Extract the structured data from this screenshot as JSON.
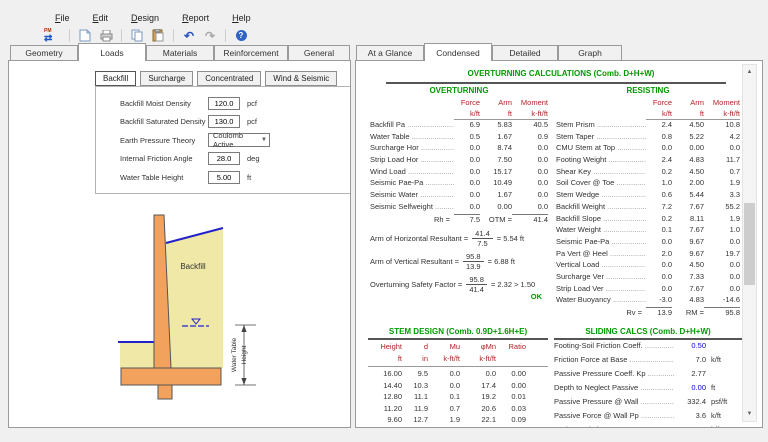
{
  "menu": {
    "items": [
      "File",
      "Edit",
      "Design",
      "Report",
      "Help"
    ]
  },
  "toolbar": {
    "pm_label": "PM",
    "icons": [
      "pm-toggle",
      "new-document",
      "print",
      "copy",
      "paste",
      "undo",
      "redo",
      "help"
    ]
  },
  "tabs_left": [
    "Geometry",
    "Loads",
    "Materials",
    "Reinforcement",
    "General"
  ],
  "tabs_right": [
    "At a Glance",
    "Condensed",
    "Detailed",
    "Graph"
  ],
  "loads_panel": {
    "subtabs": [
      "Backfill",
      "Surcharge",
      "Concentrated",
      "Wind & Seismic"
    ],
    "fields": [
      {
        "label": "Backfill Moist Density",
        "value": "120.0",
        "unit": "pcf"
      },
      {
        "label": "Backfill Saturated Density",
        "value": "130.0",
        "unit": "pcf"
      },
      {
        "label": "Earth Pressure Theory",
        "value": "Coulomb Active",
        "unit": ""
      },
      {
        "label": "Internal Friction Angle",
        "value": "28.0",
        "unit": "deg"
      },
      {
        "label": "Water Table Height",
        "value": "5.00",
        "unit": "ft"
      }
    ],
    "diagram": {
      "backfill_label": "Backfill",
      "dim_line1": "Water Table",
      "dim_line2": "Height"
    }
  },
  "colors": {
    "title_green": "#009900",
    "header_red": "#b22222",
    "input_blue": "#0000DD",
    "wall_orange": "#F2A25C",
    "soil_yellow": "#EFE8A7",
    "water_blue": "#2222CC"
  },
  "condensed": {
    "title": "OVERTURNING CALCULATIONS (Comb. D+H+W)",
    "overturning": {
      "heading": "OVERTURNING",
      "headers": {
        "force": "Force",
        "arm": "Arm",
        "moment": "Moment",
        "force_u": "k/ft",
        "arm_u": "ft",
        "moment_u": "k-ft/ft"
      },
      "rows": [
        {
          "label": "Backfill Pa",
          "force": "6.9",
          "arm": "5.83",
          "moment": "40.5"
        },
        {
          "label": "Water Table",
          "force": "0.5",
          "arm": "1.67",
          "moment": "0.9"
        },
        {
          "label": "Surcharge Hor",
          "force": "0.0",
          "arm": "8.74",
          "moment": "0.0"
        },
        {
          "label": "Strip Load Hor",
          "force": "0.0",
          "arm": "7.50",
          "moment": "0.0"
        },
        {
          "label": "Wind Load",
          "force": "0.0",
          "arm": "15.17",
          "moment": "0.0"
        },
        {
          "label": "Seismic Pae-Pa",
          "force": "0.0",
          "arm": "10.49",
          "moment": "0.0"
        },
        {
          "label": "Seismic Water",
          "force": "0.0",
          "arm": "1.67",
          "moment": "0.0"
        },
        {
          "label": "Seismic Selfweight",
          "force": "0.0",
          "arm": "0.00",
          "moment": "0.0"
        }
      ],
      "total": {
        "label": "Rh =",
        "force": "7.5",
        "otm_label": "OTM =",
        "moment": "41.4"
      }
    },
    "resisting": {
      "heading": "RESISTING",
      "headers": {
        "force": "Force",
        "arm": "Arm",
        "moment": "Moment",
        "force_u": "k/ft",
        "arm_u": "ft",
        "moment_u": "k-ft/ft"
      },
      "rows": [
        {
          "label": "Stem Prism",
          "force": "2.4",
          "arm": "4.50",
          "moment": "10.8"
        },
        {
          "label": "Stem Taper",
          "force": "0.8",
          "arm": "5.22",
          "moment": "4.2"
        },
        {
          "label": "CMU Stem at Top",
          "force": "0.0",
          "arm": "0.00",
          "moment": "0.0"
        },
        {
          "label": "Footing Weight",
          "force": "2.4",
          "arm": "4.83",
          "moment": "11.7"
        },
        {
          "label": "Shear Key",
          "force": "0.2",
          "arm": "4.50",
          "moment": "0.7"
        },
        {
          "label": "Soil Cover @ Toe",
          "force": "1.0",
          "arm": "2.00",
          "moment": "1.9"
        },
        {
          "label": "Stem Wedge",
          "force": "0.6",
          "arm": "5.44",
          "moment": "3.3"
        },
        {
          "label": "Backfill Weight",
          "force": "7.2",
          "arm": "7.67",
          "moment": "55.2"
        },
        {
          "label": "Backfill Slope",
          "force": "0.2",
          "arm": "8.11",
          "moment": "1.9"
        },
        {
          "label": "Water Weight",
          "force": "0.1",
          "arm": "7.67",
          "moment": "1.0"
        },
        {
          "label": "Seismic Pae-Pa",
          "force": "0.0",
          "arm": "9.67",
          "moment": "0.0"
        },
        {
          "label": "Pa Vert @ Heel",
          "force": "2.0",
          "arm": "9.67",
          "moment": "19.7"
        },
        {
          "label": "Vertical Load",
          "force": "0.0",
          "arm": "4.50",
          "moment": "0.0"
        },
        {
          "label": "Surcharge Ver",
          "force": "0.0",
          "arm": "7.33",
          "moment": "0.0"
        },
        {
          "label": "Strip Load Ver",
          "force": "0.0",
          "arm": "7.67",
          "moment": "0.0"
        },
        {
          "label": "Water Buoyancy",
          "force": "-3.0",
          "arm": "4.83",
          "moment": "-14.6"
        }
      ],
      "total": {
        "label": "Rv =",
        "force": "13.9",
        "rm_label": "RM =",
        "moment": "95.8"
      }
    },
    "formulas": [
      {
        "label": "Arm of Horizontal Resultant =",
        "numerator": "41.4",
        "denominator": "7.5",
        "result": "= 5.54 ft"
      },
      {
        "label": "Arm of Vertical Resultant =",
        "numerator": "95.8",
        "denominator": "13.9",
        "result": "= 6.88 ft"
      },
      {
        "label": "Overturning Safety Factor =",
        "numerator": "95.8",
        "denominator": "41.4",
        "result": "= 2.32 > 1.50"
      }
    ],
    "ok_label": "OK",
    "stem_design": {
      "title": "STEM DESIGN (Comb. 0.9D+1.6H+E)",
      "headers": [
        "Height",
        "d",
        "Mu",
        "φMn",
        "Ratio"
      ],
      "units": [
        "ft",
        "in",
        "k-ft/ft",
        "k-ft/ft",
        ""
      ],
      "rows": [
        [
          "16.00",
          "9.5",
          "0.0",
          "0.0",
          "0.00"
        ],
        [
          "14.40",
          "10.3",
          "0.0",
          "17.4",
          "0.00"
        ],
        [
          "12.80",
          "11.1",
          "0.1",
          "19.2",
          "0.01"
        ],
        [
          "11.20",
          "11.9",
          "0.7",
          "20.6",
          "0.03"
        ],
        [
          "9.60",
          "12.7",
          "1.9",
          "22.1",
          "0.09"
        ]
      ]
    },
    "sliding": {
      "title": "SLIDING CALCS (Comb. D+H+W)",
      "rows": [
        {
          "label": "Footing-Soil Friction Coeff.",
          "value": "0.50",
          "unit": "",
          "blue": true
        },
        {
          "label": "Friction Force at Base",
          "value": "7.0",
          "unit": "k/ft"
        },
        {
          "label": "Passive Pressure Coeff. Kp",
          "value": "2.77",
          "unit": ""
        },
        {
          "label": "Depth to Neglect Passive",
          "value": "0.00",
          "unit": "ft",
          "blue": true
        },
        {
          "label": "Passive Pressure @ Wall",
          "value": "332.4",
          "unit": "psf/ft"
        },
        {
          "label": "Passive Force @ Wall Pp",
          "value": "3.6",
          "unit": "k/ft"
        },
        {
          "label": "Horiz. Resisting Force",
          "value": "10.6",
          "unit": "k/ft"
        }
      ]
    }
  }
}
